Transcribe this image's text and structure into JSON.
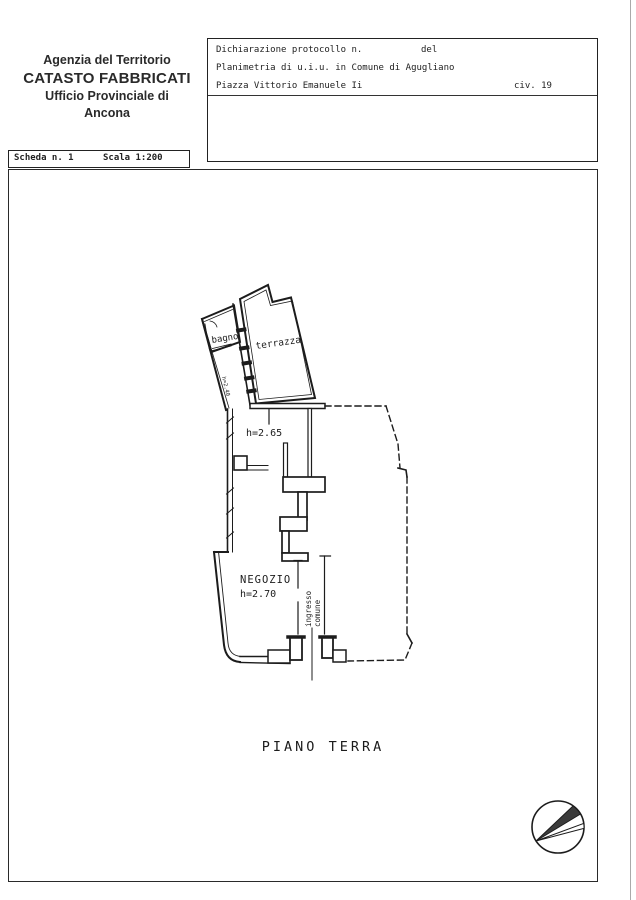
{
  "header": {
    "line1": "Agenzia del Territorio",
    "line2": "CATASTO FABBRICATI",
    "line3": "Ufficio Provinciale di",
    "line4": "Ancona"
  },
  "info_box": {
    "protocol_label": "Dichiarazione protocollo n.",
    "protocol_del": "del",
    "planimetria_line": "Planimetria di u.i.u. in Comune di Agugliano",
    "address": "Piazza Vittorio Emanuele Ii",
    "civic": "civ. 19"
  },
  "scheda_box": {
    "scheda": "Scheda n. 1",
    "scala": "Scala 1:200"
  },
  "plan": {
    "room_bagno": "bagno",
    "room_terrazza": "terrazza",
    "height_side": "h=2.40",
    "height_main": "h=2.65",
    "room_negozio": "NEGOZIO",
    "height_negozio": "h=2.70",
    "ingresso_line1": "ingresso",
    "ingresso_line2": "comune",
    "floor_label": "PIANO TERRA"
  },
  "colors": {
    "ink": "#1c1c1c",
    "paper": "#ffffff"
  }
}
